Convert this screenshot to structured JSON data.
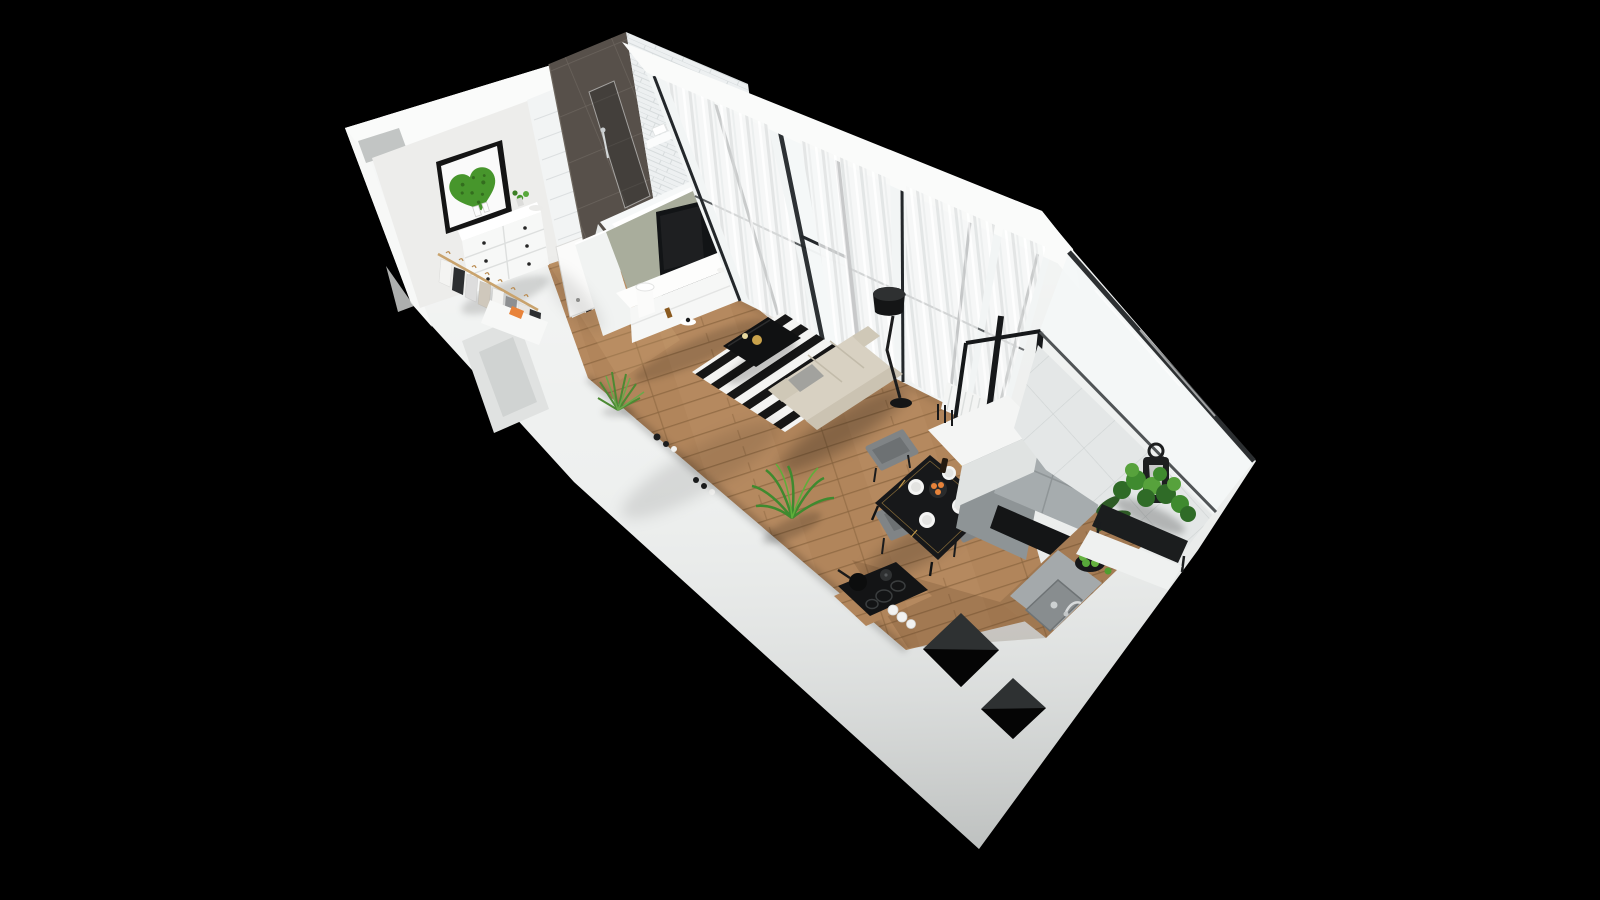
{
  "scene": {
    "kind": "isometric-3d-floor-plan-render",
    "background_color": "#000000",
    "palette": {
      "wall_white": "#eff1f0",
      "wall_top_white": "#fafbfa",
      "floor_wood": "#b5895f",
      "floor_wood_seam": "#8a653f",
      "bathroom_dark_tile": "#57504a",
      "bathroom_light_tile": "#edf0f1",
      "tv_wall_sage": "#a9ad9c",
      "tv_black": "#121416",
      "rug_dark": "#161616",
      "rug_light": "#f4f4f2",
      "sofa_cream": "#d8d1c2",
      "curtain_white": "#f7f8f8",
      "window_frame_dark": "#23272a",
      "balcony_floor": "#e4e7e7",
      "plant_green": "#47962c",
      "kitchen_gray": "#8e9496",
      "chair_gray": "#808486",
      "orange_fruit": "#e8833a",
      "apple_green": "#64b13e"
    },
    "rooms": [
      {
        "id": "hallway",
        "furniture": [
          "moss-heart-wall-art",
          "white-dresser",
          "clothes-rack",
          "shoe-bench"
        ]
      },
      {
        "id": "bathroom",
        "furniture": [
          "bathtub",
          "toilet",
          "shower",
          "towel-shelf"
        ]
      },
      {
        "id": "living-room",
        "furniture": [
          "tv",
          "tv-lowboard",
          "table-lamp",
          "striped-rug",
          "coffee-table",
          "sofa",
          "floor-lamp",
          "palm-plant",
          "window-wall-with-curtains",
          "radiator"
        ]
      },
      {
        "id": "kitchen-dining",
        "furniture": [
          "dining-table",
          "dining-chairs",
          "induction-hob",
          "pots",
          "sink",
          "fruit-bowl",
          "tall-cabinet",
          "wood-counter"
        ]
      },
      {
        "id": "balcony",
        "furniture": [
          "glass-railing",
          "lantern",
          "planter-box",
          "plants"
        ]
      }
    ],
    "counts": {
      "dining_chairs": 3,
      "place_settings": 4,
      "wardrobe_garments": 8,
      "wall_openings": 2
    }
  }
}
